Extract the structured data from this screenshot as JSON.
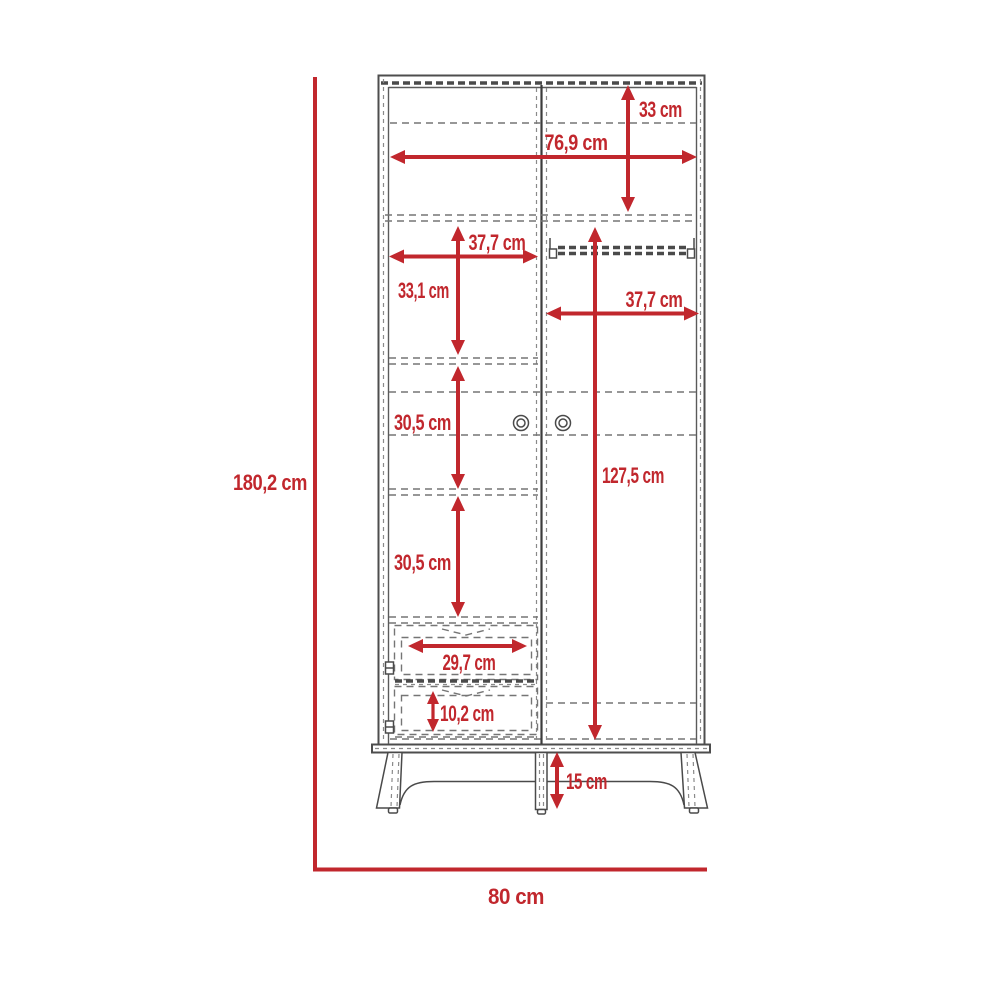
{
  "diagram": {
    "type": "furniture-dimension-drawing",
    "subject": "two-door wardrobe with two drawers and legs",
    "unit": "cm",
    "colors": {
      "dimension_red": "#c1272d",
      "outline_gray": "#4d4d4d",
      "dashed_gray": "#757575",
      "background": "#ffffff"
    },
    "labels": {
      "top_section_height": "33 cm",
      "interior_width": "76,9 cm",
      "left_section_width": "37,7 cm",
      "left_upper_section_height": "33,1 cm",
      "right_section_width": "37,7 cm",
      "right_door_interior_height": "127,5 cm",
      "left_middle_section_height": "30,5 cm",
      "left_lower_section_height": "30,5 cm",
      "drawer_width": "29,7 cm",
      "drawer_height": "10,2 cm",
      "leg_height": "15 cm",
      "overall_height": "180,2 cm",
      "overall_width": "80 cm"
    }
  }
}
